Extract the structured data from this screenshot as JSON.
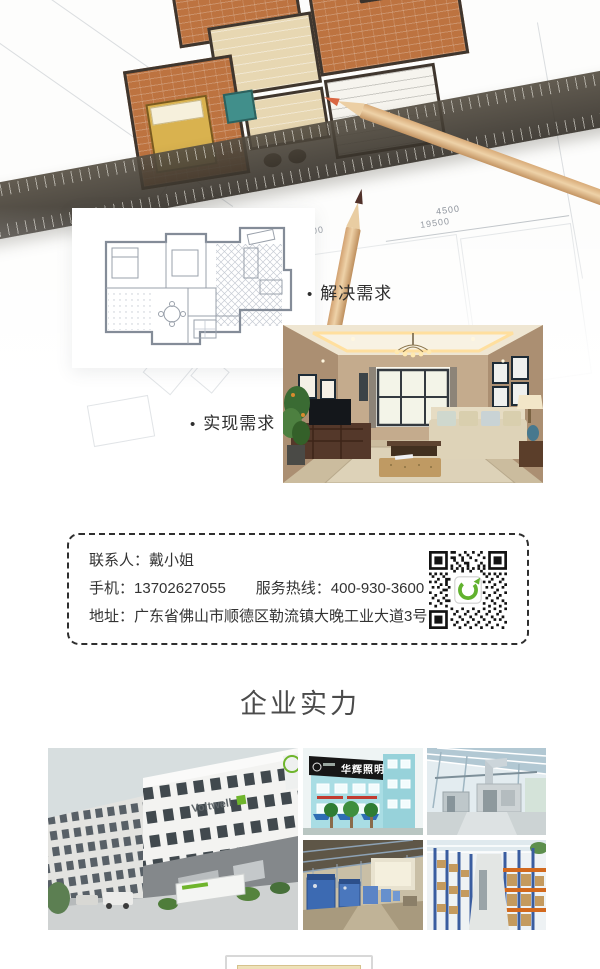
{
  "colors": {
    "accent_green": "#62b22f",
    "heading_text": "#4b4b4b",
    "body_text": "#333333",
    "dashed_border": "#2e2e2e",
    "terracotta_floor": "#bd7340"
  },
  "icons": {
    "qr": "qr-code"
  },
  "hero": {
    "marker": "•",
    "solve_label": "解决需求",
    "realize_label": "实现需求",
    "dims": {
      "d1": "5100",
      "d2": "19500",
      "d3": "4500"
    }
  },
  "contact": {
    "contact_label": "联系人：",
    "contact_value": "戴小姐",
    "mobile_label": "手机：",
    "mobile_value": "13702627055",
    "hotline_label": "服务热线：",
    "hotline_value": "400-930-3600",
    "address_label": "地址：",
    "address_value": "广东省佛山市顺德区勒流镇大晚工业大道3号"
  },
  "strength": {
    "title": "企业实力"
  },
  "gallery": {
    "voltwell_brand": "Voltwell",
    "huahui_sign": "华辉照明"
  }
}
